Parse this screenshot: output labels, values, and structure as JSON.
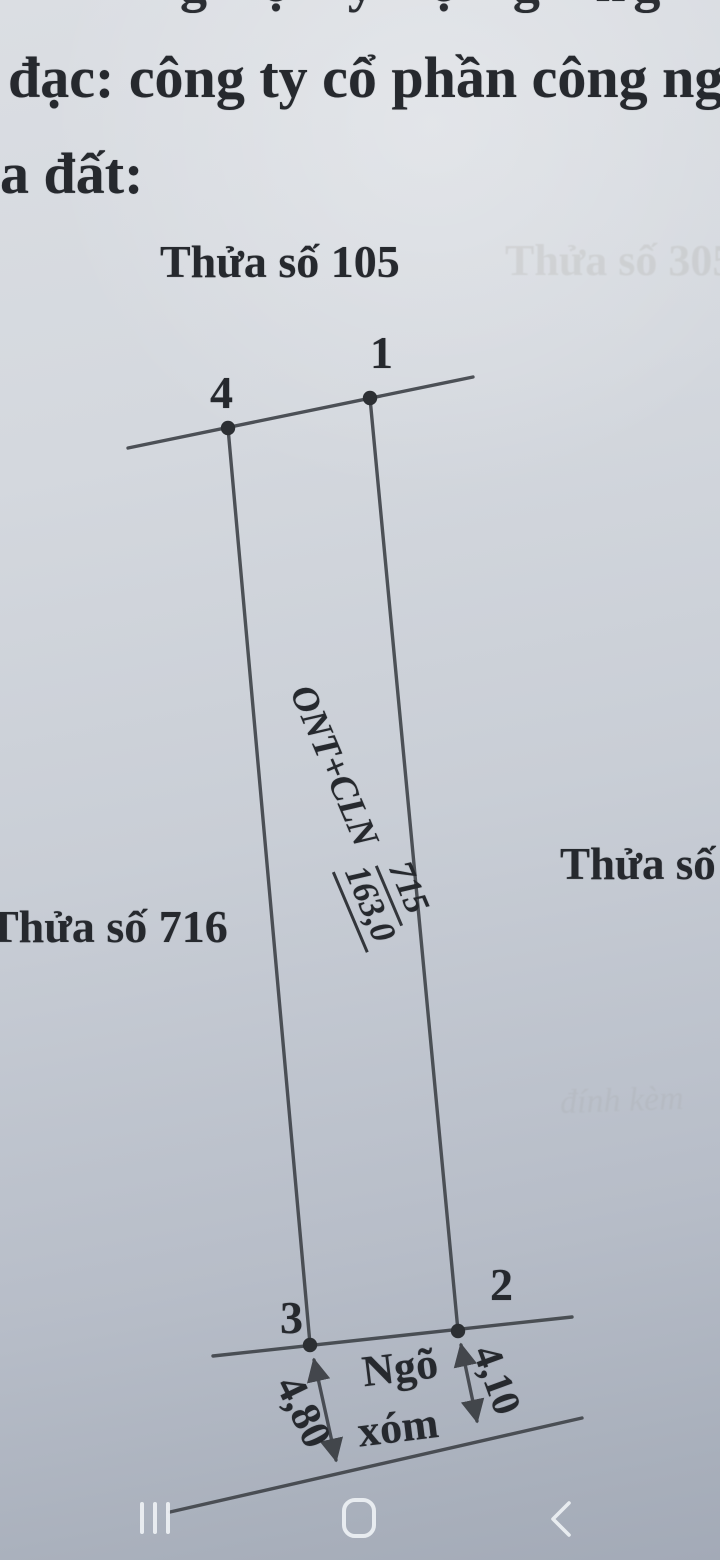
{
  "screen": {
    "header": {
      "clipped_top_line": "g ợ y ọ g ng",
      "line1": "đạc: công ty cổ phần công ng",
      "line2": "a đất:"
    },
    "diagram": {
      "parcel_top": "Thửa số 105",
      "parcel_left": "Thửa số 716",
      "parcel_right": "Thửa số 3",
      "ghost_parcel": "Thửa số 305",
      "ghost_note": "đính kèm",
      "points": {
        "p1": "1",
        "p2": "2",
        "p3": "3",
        "p4": "4"
      },
      "center_label": {
        "land_use": "ONT+CLN",
        "parcel_number": "715",
        "area": "163,0"
      },
      "dimension_left": "4,80",
      "dimension_right": "4,10",
      "road_line1": "Ngõ",
      "road_line2": "xóm"
    },
    "colors": {
      "paper_top": "#dbdee3",
      "paper_bottom": "#a3aab7",
      "ink": "#26292e",
      "line": "#41454b",
      "nav_icon": "#eef1f4"
    }
  }
}
